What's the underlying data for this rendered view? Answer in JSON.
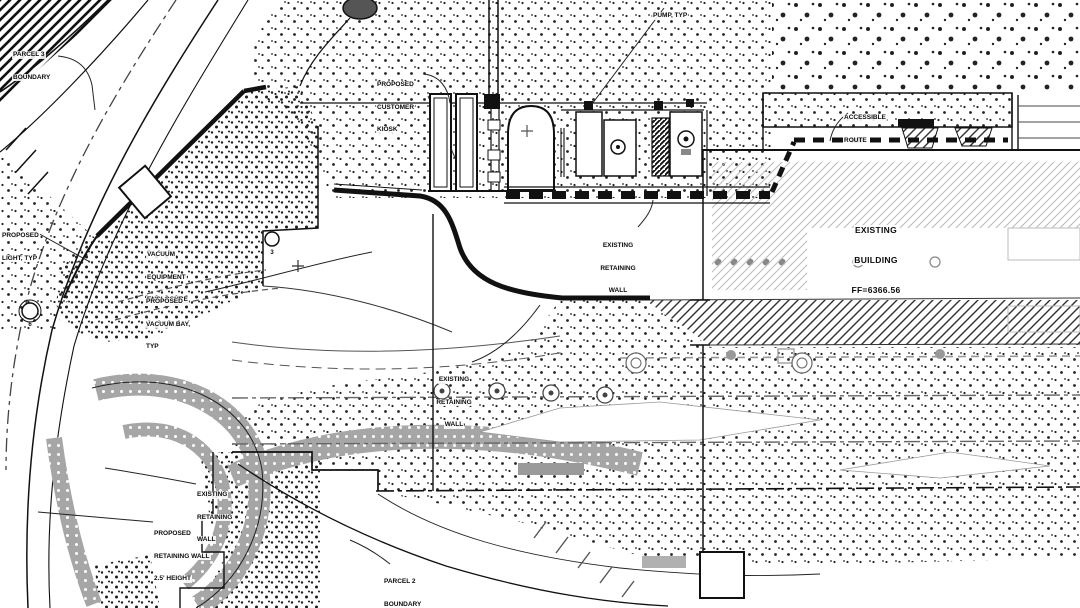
{
  "drawing": {
    "title": "civil site plan sheet (car wash site - partial view)",
    "labels": {
      "parcel3_boundary": {
        "line1": "PARCEL 3",
        "line2": "BOUNDARY"
      },
      "proposed_light": {
        "line1": "PROPOSED",
        "line2": "LIGHT, TYP"
      },
      "vacuum_enclosure": {
        "line1": "VACUUM",
        "line2": "EQUIPMENT",
        "line3": "ENCLOSURE"
      },
      "proposed_vacuum_bay": {
        "line1": "PROPOSED",
        "line2": "VACUUM BAY,",
        "line3": "TYP"
      },
      "proposed_customer_kiosk": {
        "line1": "PROPOSED",
        "line2": "CUSTOMER",
        "line3": "KIOSK"
      },
      "pump_typ": {
        "line1": "PUMP, TYP"
      },
      "accessible_route": {
        "line1": "ACCESSIBLE",
        "line2": "ROUTE"
      },
      "existing_building": {
        "line1": "EXISTING",
        "line2": "BUILDING",
        "line3": "FF=6366.56"
      },
      "existing_retaining_wall_upper": {
        "line1": "EXISTING",
        "line2": "RETAINING",
        "line3": "WALL"
      },
      "existing_retaining_wall_mid": {
        "line1": "EXISTING",
        "line2": "RETAINING",
        "line3": "WALL"
      },
      "existing_retaining_wall_lower": {
        "line1": "EXISTING",
        "line2": "RETAINING",
        "line3": "WALL"
      },
      "proposed_retaining_wall": {
        "line1": "PROPOSED",
        "line2": "RETAINING WALL",
        "line3": "2.5' HEIGHT"
      },
      "parcel2_boundary": {
        "line1": "PARCEL 2",
        "line2": "BOUNDARY"
      },
      "keynote_3": "3",
      "keynote_6": "6"
    },
    "colors": {
      "ink": "#111111",
      "gray": "#8f8f8f",
      "light_gray": "#bbbbbb",
      "band_gray": "#a6a6a6",
      "paper": "#ffffff"
    }
  }
}
